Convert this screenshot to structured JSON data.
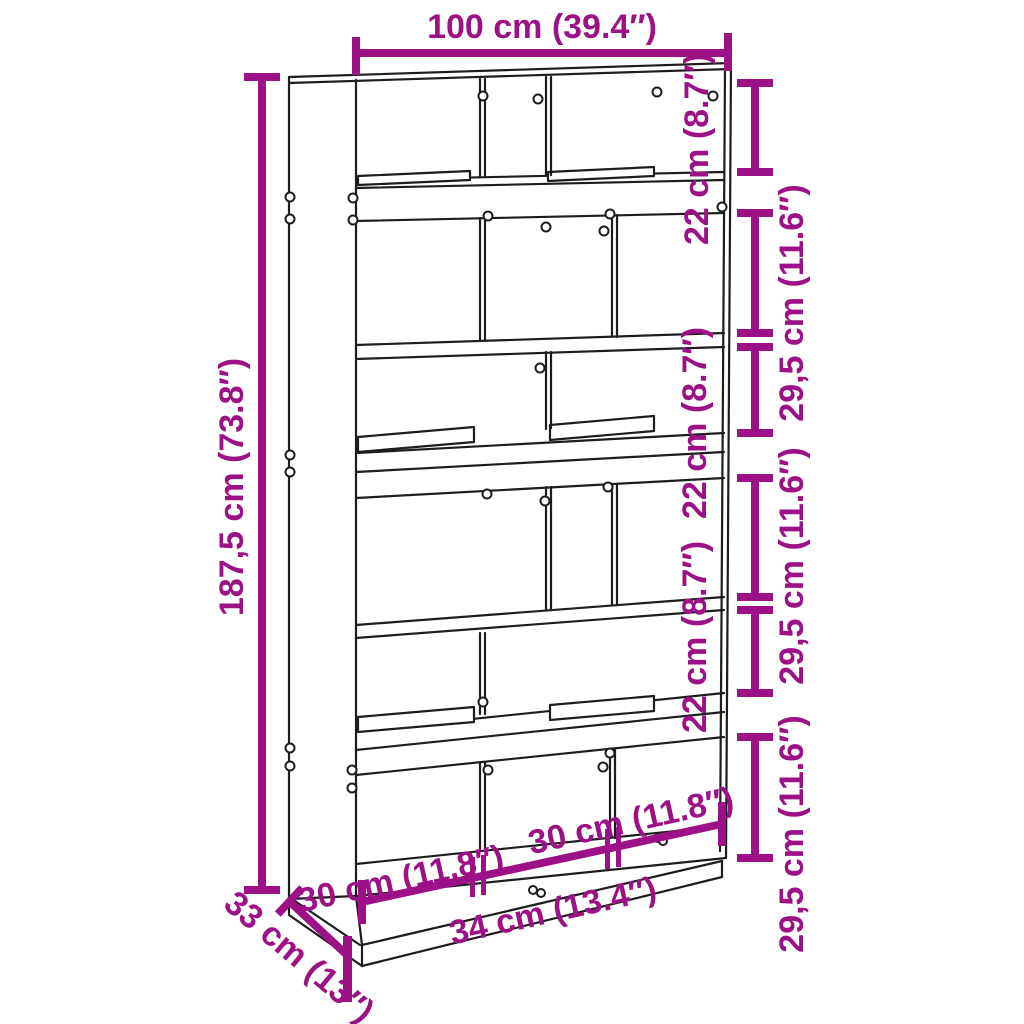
{
  "colors": {
    "accent": "#9C1185",
    "line_art": "#1D1D1D",
    "background": "#FFFFFF"
  },
  "dimensions": {
    "top_width": "100 cm (39.4″)",
    "left_height": "187,5 cm (73.8″)",
    "right_side": [
      {
        "id": "r1",
        "label": "22 cm (8.7″)"
      },
      {
        "id": "r2",
        "label": "29,5 cm (11.6″)"
      },
      {
        "id": "r3",
        "label": "22 cm (8.7″)"
      },
      {
        "id": "r4",
        "label": "29,5 cm (11.6″)"
      },
      {
        "id": "r5",
        "label": "22 cm (8.7″)"
      },
      {
        "id": "r6",
        "label": "29,5 cm (11.6″)"
      }
    ],
    "bottom_compartments": [
      {
        "id": "bottom-left",
        "label": "30 cm (11.8″)"
      },
      {
        "id": "bottom-center",
        "label": "34 cm (13.4″)"
      },
      {
        "id": "bottom-right",
        "label": "30 cm (11.8″)"
      }
    ],
    "depth": "33 cm (13″)"
  }
}
